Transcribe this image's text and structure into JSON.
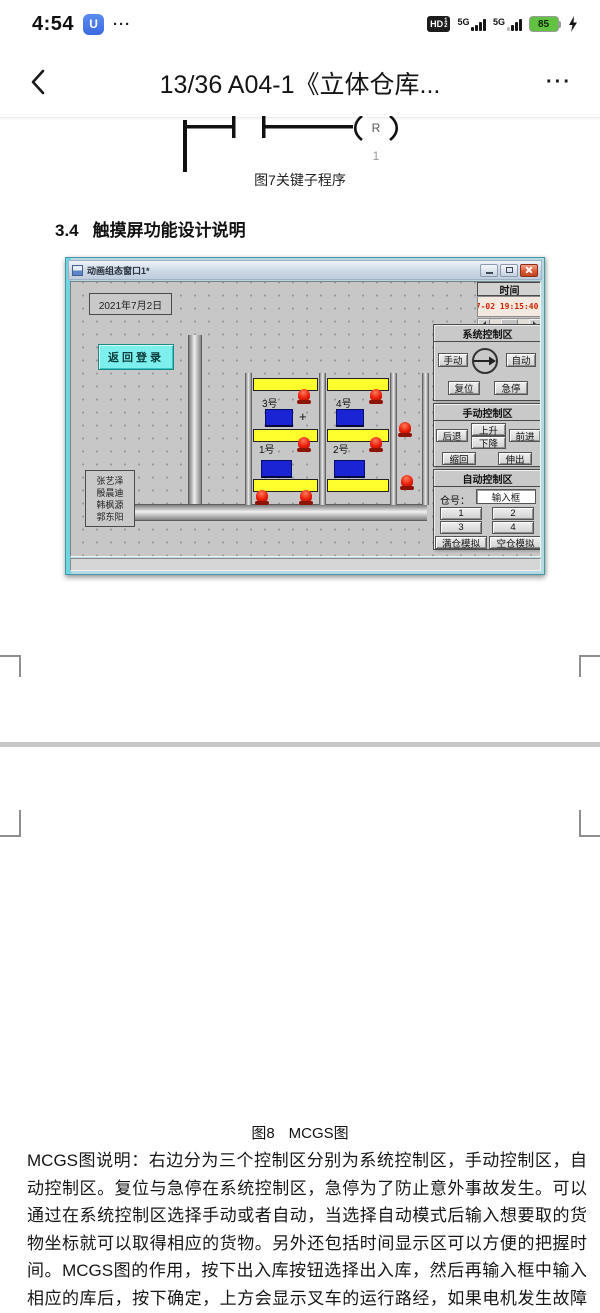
{
  "status_bar": {
    "time": "4:54",
    "app_glyph": "U",
    "more": "···",
    "hd": "HD",
    "hd_1": "1",
    "hd_2": "2",
    "net1": "5G",
    "net2": "5G",
    "battery": "85"
  },
  "nav": {
    "title": "13/36 A04-1《立体仓库...",
    "more": "···"
  },
  "figure7": {
    "coil": "R",
    "coil_num": "1",
    "caption": "图7关键子程序"
  },
  "section": {
    "number": "3.4",
    "title": "触摸屏功能设计说明"
  },
  "mcgs": {
    "window_title": "动画组态窗口1*",
    "date": "2021年7月2日",
    "time_header": "时间",
    "time_value": "07-02 19:15:40.1",
    "back_login": "返回登录",
    "team_names": [
      "张艺泽",
      "殷晨迪",
      "韩枫源",
      "郭东阳"
    ],
    "system_area": {
      "title": "系统控制区",
      "manual": "手动",
      "auto": "自动",
      "reset": "复位",
      "estop": "急停"
    },
    "manual_area": {
      "title": "手动控制区",
      "backward": "后退",
      "up": "上升",
      "down": "下降",
      "forward": "前进",
      "retract": "缩回",
      "extend": "伸出"
    },
    "auto_area": {
      "title": "自动控制区",
      "bin_label": "仓号：",
      "input_text": "输入框",
      "btn1": "1",
      "btn2": "2",
      "btn3": "3",
      "btn4": "4",
      "full_sim": "满仓模拟",
      "empty_sim": "空仓模拟"
    },
    "bins": {
      "b1": "1号",
      "b2": "2号",
      "b3": "3号",
      "b4": "4号",
      "plus": "+"
    }
  },
  "figure8": {
    "caption_fig": "图8",
    "caption_name": "MCGS图"
  },
  "description": "MCGS图说明：右边分为三个控制区分别为系统控制区，手动控制区，自动控制区。复位与急停在系统控制区，急停为了防止意外事故发生。可以通过在系统控制区选择手动或者自动，当选择自动模式后输入想要取的货物坐标就可以取得相应的货物。另外还包括时间显示区可以方便的把握时间。MCGS图的作用，按下出入库按钮选择出入库，然后再输入框中输入相应的库后，按下确定，上方会显示叉车的运行路经，如果电机发生故障的话，警报指示区的会亮起相应的灯。",
  "colors": {
    "accent_cyan": "#7df0ee",
    "shelf_yellow": "#ffff2e",
    "cargo_blue": "#1a24d4",
    "lamp_red": "#ea1c08",
    "time_red": "#cf2200",
    "frame_teal": "#6fd6e0",
    "battery_green": "#62c342"
  }
}
